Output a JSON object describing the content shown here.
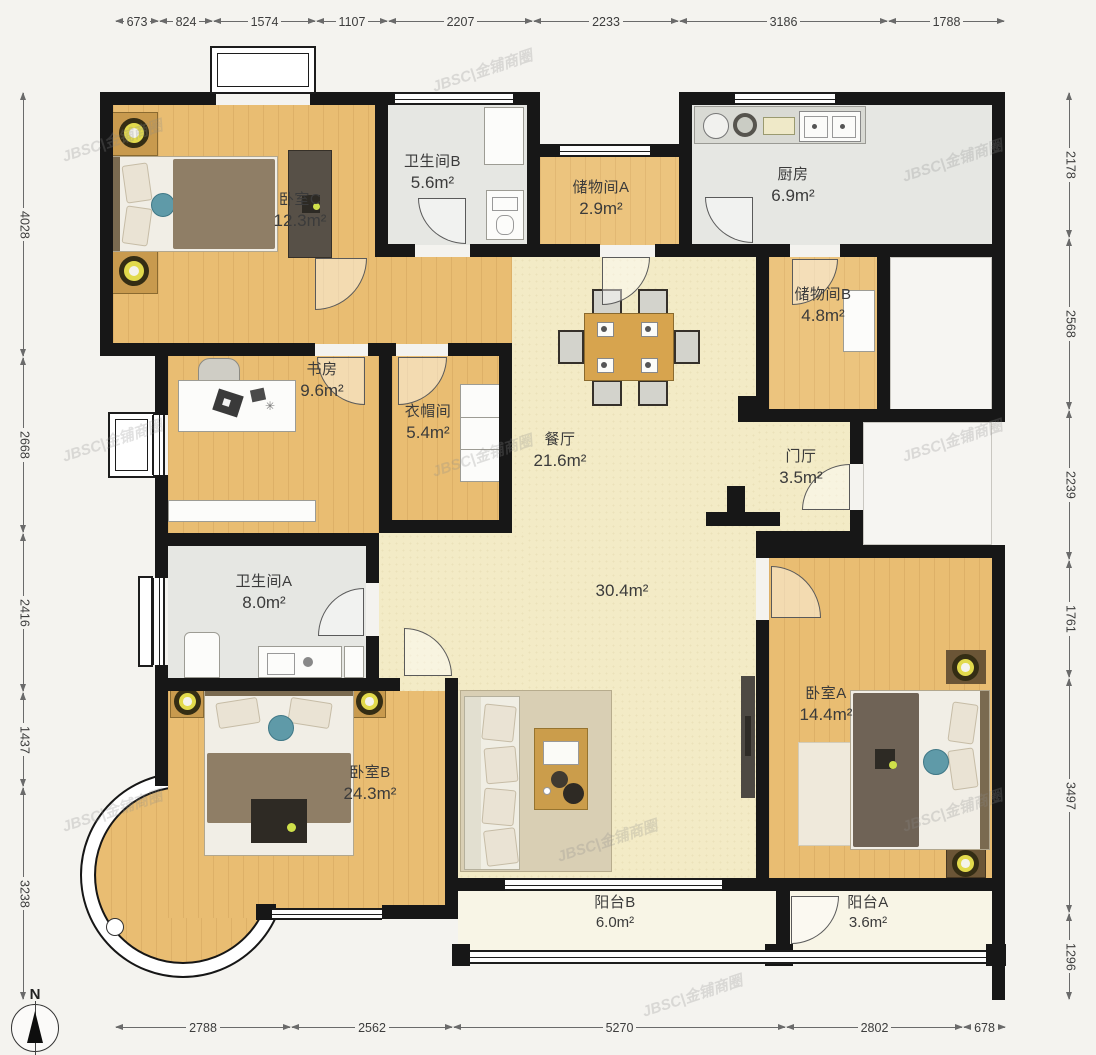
{
  "compass": {
    "label": "N"
  },
  "watermark": {
    "text": "JBSC|金铺商圈"
  },
  "rooms": [
    {
      "key": "bedroomC",
      "name": "卧室C",
      "area": "12.3m²"
    },
    {
      "key": "bathB",
      "name": "卫生间B",
      "area": "5.6m²"
    },
    {
      "key": "storageA",
      "name": "储物间A",
      "area": "2.9m²"
    },
    {
      "key": "kitchen",
      "name": "厨房",
      "area": "6.9m²"
    },
    {
      "key": "storageB",
      "name": "储物间B",
      "area": "4.8m²"
    },
    {
      "key": "study",
      "name": "书房",
      "area": "9.6m²"
    },
    {
      "key": "cloakroom",
      "name": "衣帽间",
      "area": "5.4m²"
    },
    {
      "key": "dining",
      "name": "餐厅",
      "area": "21.6m²"
    },
    {
      "key": "hall",
      "name": "门厅",
      "area": "3.5m²"
    },
    {
      "key": "living",
      "name": "",
      "area": "30.4m²"
    },
    {
      "key": "bathA",
      "name": "卫生间A",
      "area": "8.0m²"
    },
    {
      "key": "bedroomB",
      "name": "卧室B",
      "area": "24.3m²"
    },
    {
      "key": "bedroomA",
      "name": "卧室A",
      "area": "14.4m²"
    },
    {
      "key": "balconyB",
      "name": "阳台B",
      "area": "6.0m²"
    },
    {
      "key": "balconyA",
      "name": "阳台A",
      "area": "3.6m²"
    }
  ],
  "dims": {
    "top": [
      "673",
      "824",
      "1574",
      "1107",
      "2207",
      "2233",
      "3186",
      "1788"
    ],
    "left": [
      "4028",
      "2668",
      "2416",
      "1437",
      "3238"
    ],
    "right": [
      "2178",
      "2568",
      "2239",
      "1761",
      "3497",
      "1296"
    ],
    "bottom": [
      "2788",
      "2562",
      "5270",
      "2802",
      "678"
    ]
  }
}
